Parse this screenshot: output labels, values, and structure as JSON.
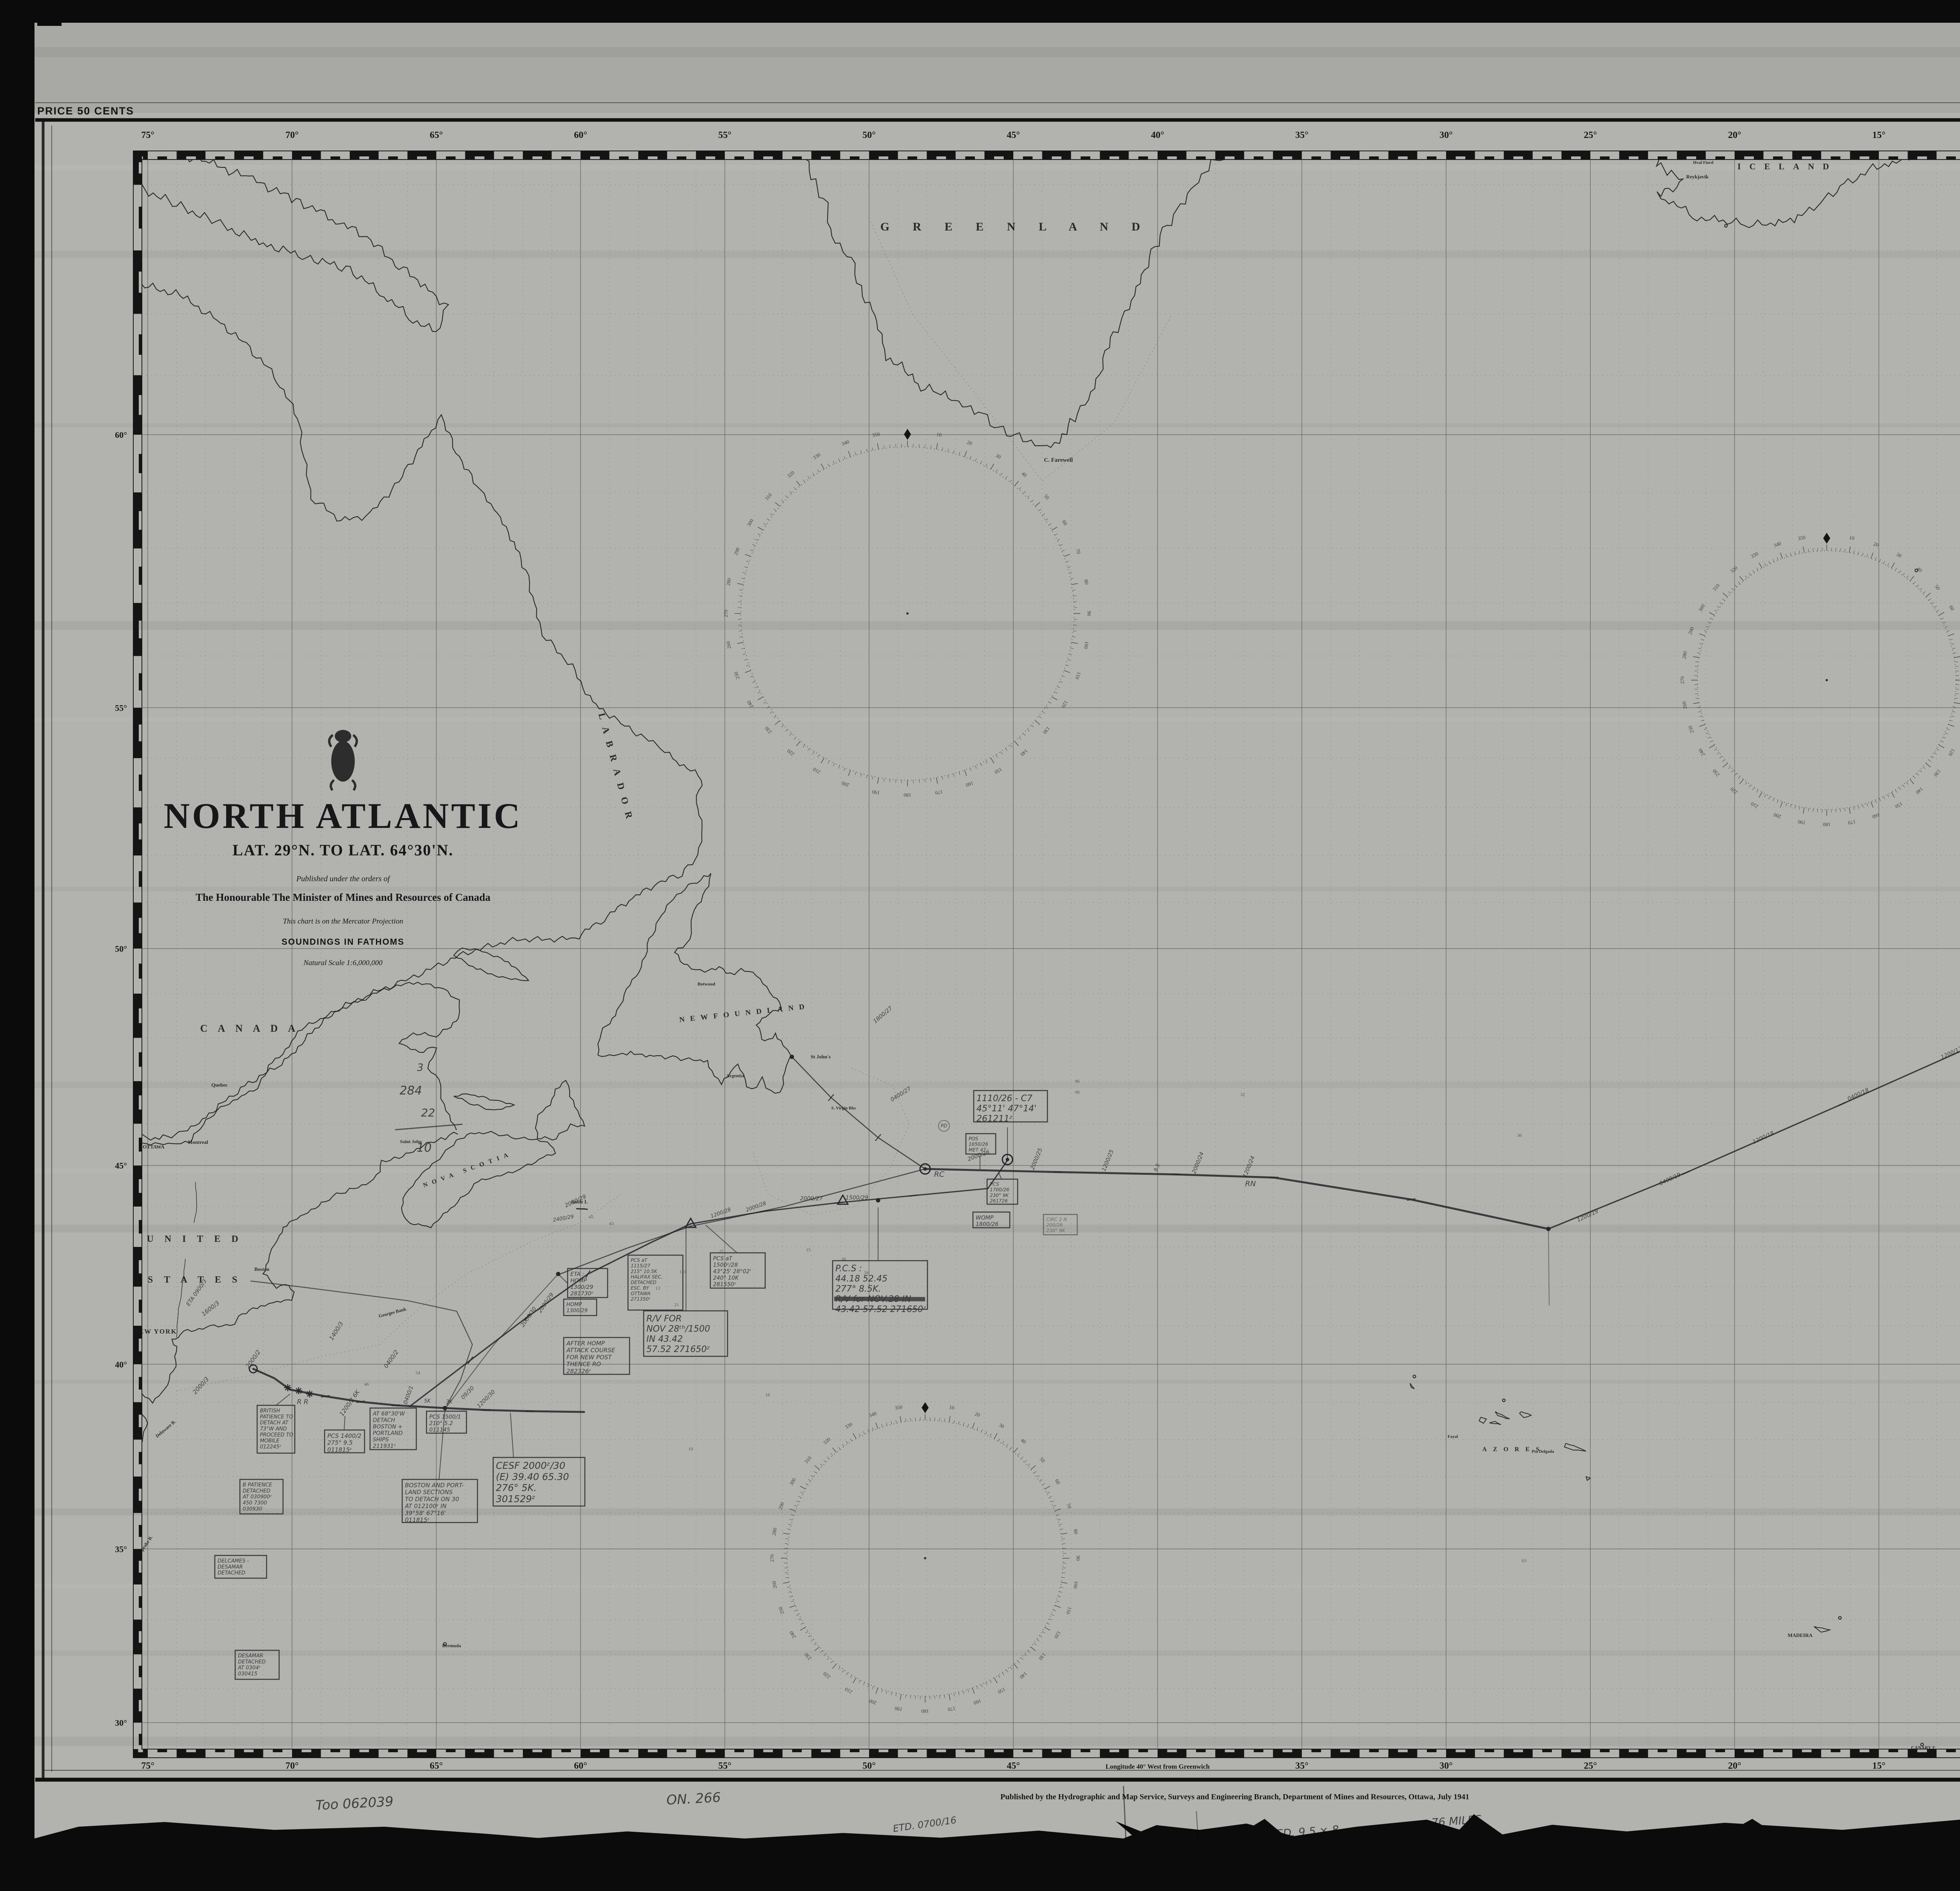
{
  "page": {
    "price": "PRICE 50 CENTS",
    "chart_number": "8-9",
    "edition_note": "First Edition 1941",
    "publisher_line": "Published by the Hydrographic and Map Service, Surveys and Engineering Branch, Department of Mines and Resources, Ottawa, July 1941"
  },
  "title_block": {
    "title": "NORTH ATLANTIC",
    "subtitle": "LAT. 29°N. TO LAT. 64°30'N.",
    "order_line": "Published under the orders of",
    "minister_line": "The Honourable The Minister of Mines and Resources of Canada",
    "projection_line": "This chart is on the Mercator Projection",
    "soundings_line": "SOUNDINGS IN FATHOMS",
    "scale_line": "Natural Scale 1:6,000,000"
  },
  "margins": {
    "top_longitudes": [
      "75°",
      "70°",
      "65°",
      "60°",
      "55°",
      "50°",
      "45°",
      "40°",
      "35°",
      "30°",
      "25°",
      "20°",
      "15°",
      "10°",
      "5°",
      "0°"
    ],
    "bottom_longitudes": [
      "75°",
      "70°",
      "65°",
      "60°",
      "55°",
      "50°",
      "45°",
      "35°",
      "30°",
      "25°",
      "20°",
      "15°",
      "10°",
      "5°",
      "0°"
    ],
    "bottom_center_label": "Longitude 40° West from Greenwich",
    "left_latitudes": [
      "60°",
      "55°",
      "50°",
      "45°",
      "40°",
      "35°",
      "30°"
    ],
    "right_latitudes": [
      "60°",
      "55°",
      "50°",
      "45°",
      "40°",
      "35°",
      "30°"
    ]
  },
  "map_labels": {
    "greenland": "G R E E N L A N D",
    "c_farewell": "C. Farewell",
    "iceland": "ICELAND",
    "reykjavik": "Reykjavik",
    "hval_fiord": "Hval Fiord",
    "labrador": "LABRADOR",
    "canada": "CANADA",
    "united": "UNITED",
    "states": "STATES",
    "ottawa": "OTTAWA",
    "montreal": "Montreal",
    "quebec": "Quebec",
    "saint_john": "Saint John",
    "nova_scotia": "NOVA SCOTIA",
    "newfoundland": "NEWFOUNDLAND",
    "botwood": "Botwood",
    "st_johns": "St John's",
    "argentia": "Argentia",
    "virgin_rks": "S. Virgin Rks",
    "sable": "Sable I.",
    "georges_bank": "Georges Bank",
    "new_york": "NEW YORK",
    "boston": "Boston",
    "delaware": "Delaware B.",
    "chesapeake": "Chesapeake B.",
    "bermuda": "Bermuda",
    "azores": "AZORES",
    "fayal": "Fayal",
    "pta_delgada": "Pta Delgada",
    "madeira": "MADEIRA",
    "canary": "CANARY Iˢ",
    "morocco": "MOROCCO",
    "gibraltar": "Gibraltar",
    "spain": "SPAIN",
    "portugal": "PORTUGAL",
    "france": "FRANCE",
    "england": "ENGLAND",
    "wales": "WALES",
    "ireland": "IRELAND",
    "scotland": "SCOTLAND",
    "st_kilda": "St Kilda",
    "faroe": "FAEROE Iˢ",
    "shetland": "SHETLAND",
    "orkney": "ORKNEY Iˢ"
  },
  "annotations": {
    "notes": [
      "1400/3",
      "ETA 0900/3",
      "1600/3",
      "2000/3",
      "2000/2",
      "0400/2",
      "1200/2 6K",
      "0400/1",
      "5K",
      "3K",
      "09/30",
      "1200/30",
      "2000/30",
      "2000/29",
      "2000/29",
      "2400/29",
      "1200/28",
      "2000/28",
      "2000/27",
      "1500/29",
      "R R",
      "RC",
      "RN",
      "0400/27",
      "1800/27",
      "2000/26",
      "2000/25",
      "1200/25",
      "9.5",
      "2000/24",
      "1200/24",
      "1200/19",
      "0400/19",
      "1200/18",
      "0400/18",
      "1200/17",
      "0400/17",
      "2000/16",
      "R/V 0730ᶻ/16",
      "1200/16",
      "PD",
      "3",
      "284",
      "22",
      "10",
      "Too 062039",
      "ON. 266",
      "ETD. 0700/16",
      "SPEED. 9.5 × 8",
      "= 76 MILES"
    ],
    "boxes": [
      {
        "lines": [
          "BRITISH",
          "PATIENCE TO",
          "DETACH AT",
          "73°W AND",
          "PROCEED TO",
          "MOBILE",
          "012245ᶻ"
        ]
      },
      {
        "lines": [
          "PCS 1400/2",
          "275° 9.5",
          "011815ᶻ"
        ]
      },
      {
        "lines": [
          "AT 68°30'W",
          "DETACH",
          "BOSTON +",
          "PORTLAND",
          "SHIPS",
          "211931ᶻ"
        ]
      },
      {
        "lines": [
          "PCS 1500/1",
          "210° 5.2",
          "011145"
        ]
      },
      {
        "lines": [
          "B PATIENCE",
          "DETACHED",
          "AT 030900ᶻ",
          "450 7300",
          "030930"
        ]
      },
      {
        "lines": [
          "BOSTON AND PORT-",
          "LAND SECTIONS",
          "TO DETACH ON 30",
          "AT 012100ᶻ IN",
          "39°58' 67°16'",
          "011815ᶻ"
        ]
      },
      {
        "lines": [
          "CESF 2000ᶻ/30",
          "(E) 39.40 65.30",
          "276°  5K.",
          "301529ᶻ"
        ]
      },
      {
        "lines": [
          "DELCAMES -",
          "DESAMAR",
          "DETACHED"
        ]
      },
      {
        "lines": [
          "DESAMAR",
          "DETACHED",
          "AT 0304ᶻ",
          "030415"
        ]
      },
      {
        "lines": [
          "ETA :",
          "HOMP",
          "1300/29",
          "281730ᶻ"
        ]
      },
      {
        "lines": [
          "HOMP",
          "1300/29"
        ]
      },
      {
        "lines": [
          "AFTER HOMP",
          "ATTACK COURSE",
          "FOR NEW POST",
          "THENCE RO",
          "282326ᶻ"
        ]
      },
      {
        "lines": [
          "PCS aT",
          "1115/27",
          "215°  10.5K",
          "HALIFAX SEC.",
          "DETACHED",
          "ESC. BY",
          "OTTAWA",
          "271350ᶻ"
        ]
      },
      {
        "lines": [
          "PCS aT",
          "1500ᶻ/28",
          "43°25' 28°02'",
          "240° 10K",
          "281550ᶻ"
        ]
      },
      {
        "lines": [
          "R/V FOR",
          "NOV 28ᵗʰ/1500",
          "IN 43.42",
          "57.52 271650ᶻ"
        ]
      },
      {
        "lines": [
          "P.C.S :",
          "44.18  52.45",
          "277°  8.5K.",
          "R/V for NOV.28 IN",
          "43.42 57.52  271650ᶻ"
        ]
      },
      {
        "lines": [
          "1110/26 - C7",
          "45°11' 47°14'",
          "261211ᶻ"
        ]
      },
      {
        "lines": [
          "POS",
          "1650/26",
          "MET 47"
        ]
      },
      {
        "lines": [
          "PCS",
          "1700/26",
          "230° 9K",
          "261726"
        ]
      },
      {
        "lines": [
          "WOMP",
          "1800/26"
        ]
      },
      {
        "lines": [
          "CIRC 2 N",
          "200/26",
          "230° 9K"
        ]
      },
      {
        "lines": [
          "PCS 2000 A",
          "48°7' 15°21'",
          "297° 131'",
          "161940"
        ]
      },
      {
        "lines": [
          "COMBATTANTE",
          "WEATHER DET.",
          "DETACH & R/V",
          "NR 3/8 2000 AT",
          "57°47' 15°13' 9ᵏ",
          "161910 A"
        ]
      }
    ]
  },
  "compass": {
    "degree_labels": [
      "0",
      "10",
      "20",
      "30",
      "40",
      "50",
      "60",
      "70",
      "80",
      "90",
      "100",
      "110",
      "120",
      "130",
      "140",
      "150",
      "160",
      "170",
      "180",
      "190",
      "200",
      "210",
      "220",
      "230",
      "240",
      "250",
      "260",
      "270",
      "280",
      "290",
      "300",
      "310",
      "320",
      "330",
      "340",
      "350"
    ]
  },
  "soundings": [
    "45",
    "110",
    "27",
    "15",
    "38",
    "13",
    "21",
    "18",
    "19",
    "32",
    "96",
    "98",
    "54",
    "46",
    "43",
    "34",
    "63",
    "36"
  ]
}
